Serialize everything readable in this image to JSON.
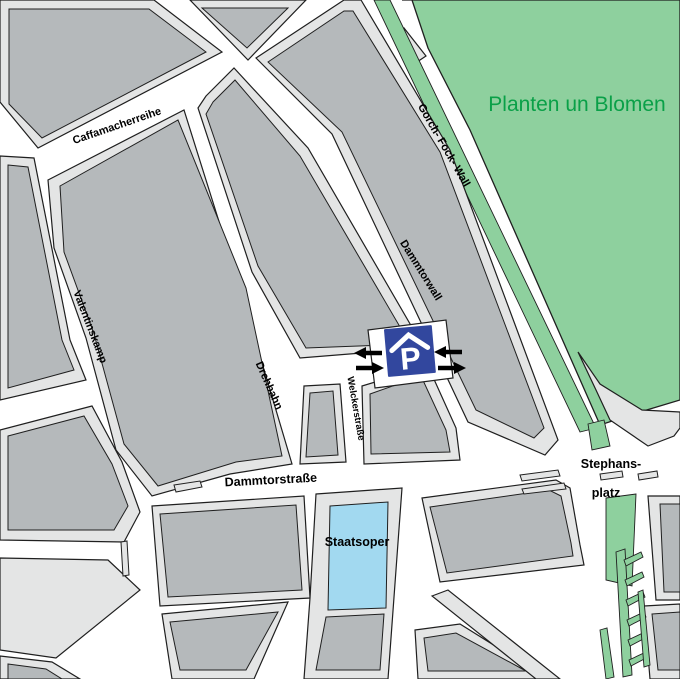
{
  "map": {
    "labels": {
      "park": "Planten un Blomen",
      "caffamacherreihe": "Caffamacherreihe",
      "valentinskamp": "Valentinskamp",
      "drehbahn": "Drehbahn",
      "dammtorwall": "Dammtorwall",
      "gorch_fock_wall": "Gorch- Fock- Wall",
      "welckerstrasse": "Welckerstraße",
      "dammtorstrasse": "Dammtorstraße",
      "stephansplatz_line1": "Stephans-",
      "stephansplatz_line2": "platz",
      "staatsoper": "Staatsoper"
    },
    "parking": {
      "symbol": "P"
    },
    "colors": {
      "street": "#ffffff",
      "sidewalk": "#e4e5e5",
      "building": "#b5b9bb",
      "outline": "#1f1f1f",
      "park_green": "#8ed09e",
      "park_label_green": "#0aa048",
      "staatsoper_blue": "#a2d9f0",
      "parking_sign_blue": "#32479e",
      "label_black": "#000000"
    }
  }
}
